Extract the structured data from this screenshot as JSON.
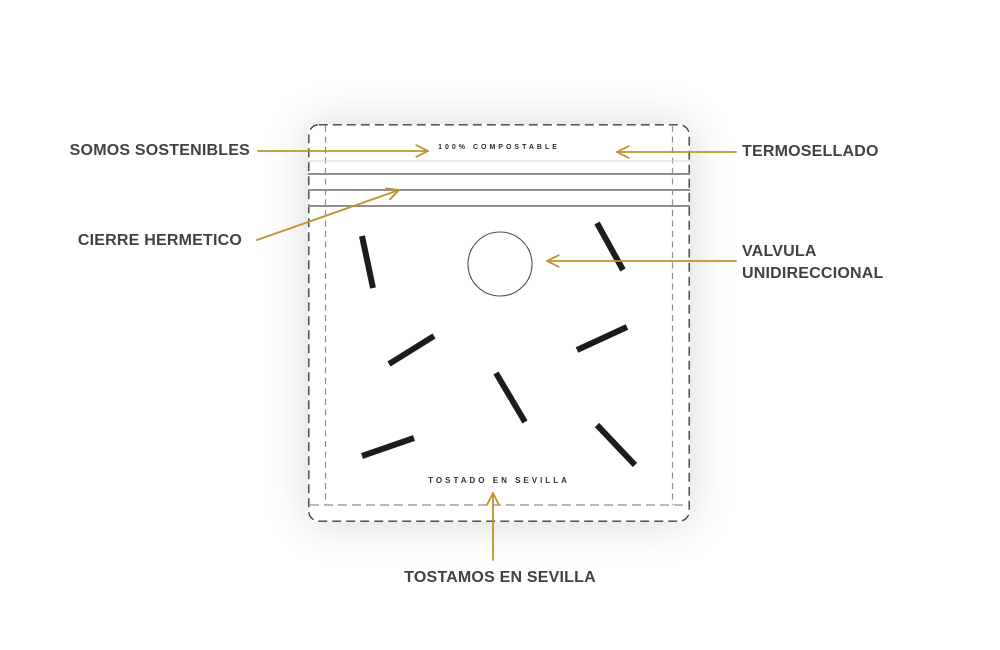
{
  "colors": {
    "accent": "#c0922f",
    "label_text": "#424242",
    "bag_outline": "#3f3f3f",
    "gusset_line": "#8f8f8f",
    "seal_line": "#8f8f8f",
    "faint_line": "#d6d6d6",
    "bean": "#1c1c1c",
    "valve_stroke": "#4d4d4d"
  },
  "callouts": {
    "somos_sostenibles": "SOMOS SOSTENIBLES",
    "termosellado": "TERMOSELLADO",
    "cierre_hermetico": "CIERRE HERMETICO",
    "valvula_unidireccional": "VALVULA UNIDIRECCIONAL",
    "tostamos_en_sevilla": "TOSTAMOS EN SEVILLA"
  },
  "bag": {
    "top_text": "100% COMPOSTABLE",
    "bottom_text": "TOSTADO EN SEVILLA"
  },
  "diagram": {
    "bag_box": {
      "x": 308,
      "y": 124,
      "w": 382,
      "h": 398,
      "radius": 10
    },
    "gusset_inset_x": 17.5,
    "gusset_bottom_y": 505,
    "inner_bottom_line_y": 505,
    "faint_line_y": 161,
    "seal_lines_y": [
      174,
      190,
      206
    ],
    "valve": {
      "cx": 500,
      "cy": 264,
      "r": 32
    },
    "beans": [
      {
        "x1": 362,
        "y1": 236,
        "x2": 373,
        "y2": 288
      },
      {
        "x1": 597,
        "y1": 223,
        "x2": 623,
        "y2": 270
      },
      {
        "x1": 389,
        "y1": 364,
        "x2": 434,
        "y2": 336
      },
      {
        "x1": 577,
        "y1": 350,
        "x2": 627,
        "y2": 327
      },
      {
        "x1": 496,
        "y1": 373,
        "x2": 525,
        "y2": 422
      },
      {
        "x1": 597,
        "y1": 425,
        "x2": 635,
        "y2": 465
      },
      {
        "x1": 362,
        "y1": 456,
        "x2": 414,
        "y2": 438
      }
    ],
    "arrows": [
      {
        "name": "somos-arrow",
        "x1": 258,
        "y1": 151,
        "x2": 428,
        "y2": 151
      },
      {
        "name": "termo-arrow",
        "x1": 736,
        "y1": 152,
        "x2": 617,
        "y2": 152
      },
      {
        "name": "cierre-arrow",
        "x1": 257,
        "y1": 240,
        "x2": 399,
        "y2": 190
      },
      {
        "name": "valvula-arrow",
        "x1": 736,
        "y1": 261,
        "x2": 547,
        "y2": 261
      },
      {
        "name": "tostamos-arrow",
        "x1": 493,
        "y1": 560,
        "x2": 493,
        "y2": 493
      }
    ]
  }
}
